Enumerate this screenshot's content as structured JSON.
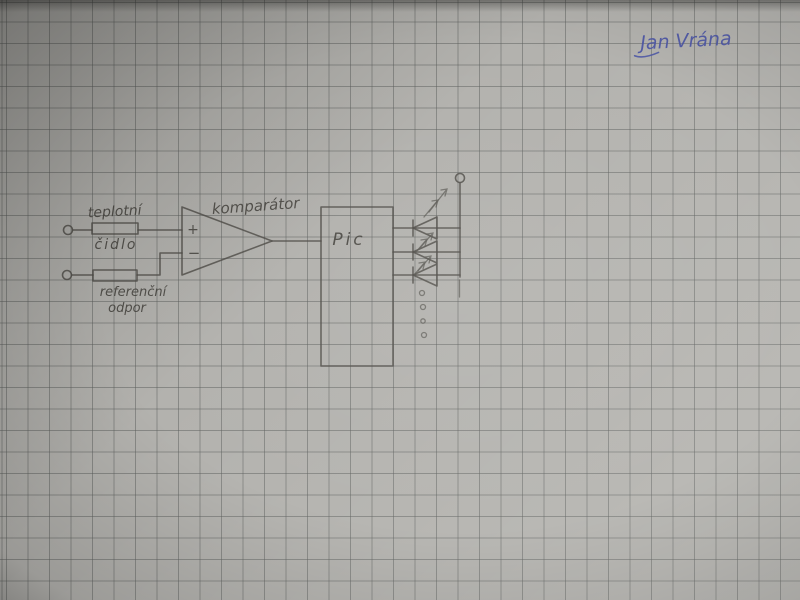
{
  "signature": {
    "text": "Jan Vrána",
    "ink_color": "#4b55a5"
  },
  "diagram": {
    "labels": {
      "sensor_line1": "teplotní",
      "sensor_line2": "čidlo",
      "reference_line1": "referenční",
      "reference_line2": "odpor",
      "comparator": "komparátor",
      "chip": "Pic",
      "plus": "+",
      "minus": "−"
    },
    "components": [
      {
        "id": "temperature-sensor",
        "symbol": "resistor-box",
        "label": "teplotní čidlo"
      },
      {
        "id": "reference-resistor",
        "symbol": "resistor-box",
        "label": "referenční odpor"
      },
      {
        "id": "comparator",
        "symbol": "op-amp-triangle",
        "label": "komparátor",
        "inputs": [
          "+",
          "−"
        ]
      },
      {
        "id": "microcontroller",
        "symbol": "rectangle",
        "label": "Pic"
      },
      {
        "id": "led-array",
        "symbol": "led-diode",
        "count": 3,
        "more_indicator": "4 dots ellipsis"
      },
      {
        "id": "supply-terminal",
        "symbol": "open-circle"
      },
      {
        "id": "input-terminal-1",
        "symbol": "open-circle"
      },
      {
        "id": "input-terminal-2",
        "symbol": "open-circle"
      }
    ]
  },
  "colors": {
    "paper": "#b3b2ae",
    "grid_line": "#5c5e5c",
    "pencil": "#4f4d48",
    "ink_blue": "#4b55a5"
  }
}
